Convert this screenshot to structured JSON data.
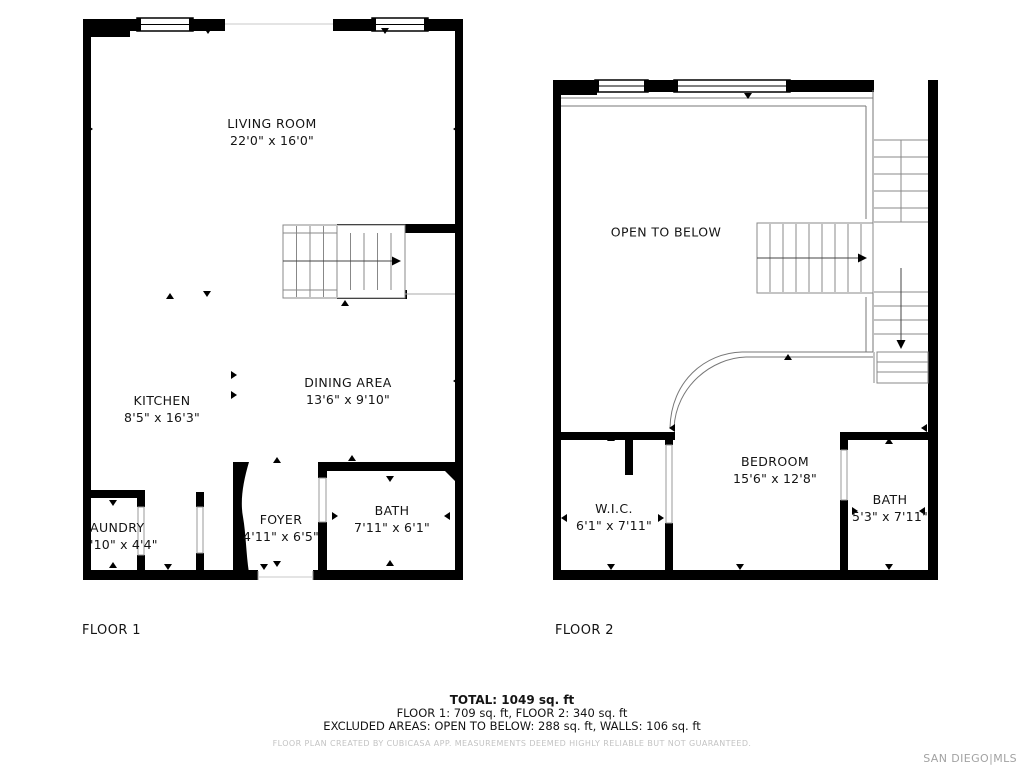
{
  "floor1": {
    "caption": "FLOOR 1",
    "rooms": [
      {
        "name": "LIVING ROOM",
        "dims": "22'0\" x 16'0\""
      },
      {
        "name": "KITCHEN",
        "dims": "8'5\" x 16'3\""
      },
      {
        "name": "DINING AREA",
        "dims": "13'6\" x 9'10\""
      },
      {
        "name": "AUNDRY",
        "dims": "'10\" x 4'4\""
      },
      {
        "name": "FOYER",
        "dims": "4'11\" x 6'5\""
      },
      {
        "name": "BATH",
        "dims": "7'11\" x 6'1\""
      }
    ]
  },
  "floor2": {
    "caption": "FLOOR 2",
    "open_label": "OPEN TO BELOW",
    "rooms": [
      {
        "name": "W.I.C.",
        "dims": "6'1\" x 7'11\""
      },
      {
        "name": "BEDROOM",
        "dims": "15'6\" x 12'8\""
      },
      {
        "name": "BATH",
        "dims": "5'3\" x 7'11\""
      }
    ]
  },
  "summary": {
    "total": "TOTAL: 1049 sq. ft",
    "floors": "FLOOR 1: 709 sq. ft, FLOOR 2: 340 sq. ft",
    "excluded": "EXCLUDED AREAS: OPEN TO BELOW: 288 sq. ft, WALLS: 106 sq. ft",
    "disclaimer": "FLOOR PLAN CREATED BY CUBICASA APP. MEASUREMENTS DEEMED HIGHLY RELIABLE BUT NOT GUARANTEED."
  },
  "watermark": "SAN DIEGO|MLS",
  "colors": {
    "wall": "#000000",
    "thin_line": "#777777",
    "door_line": "#9a9a9a",
    "faint_line": "#c8c8c8",
    "disclaimer_text": "#c3c3c3",
    "watermark_text": "#a2a2a2"
  }
}
